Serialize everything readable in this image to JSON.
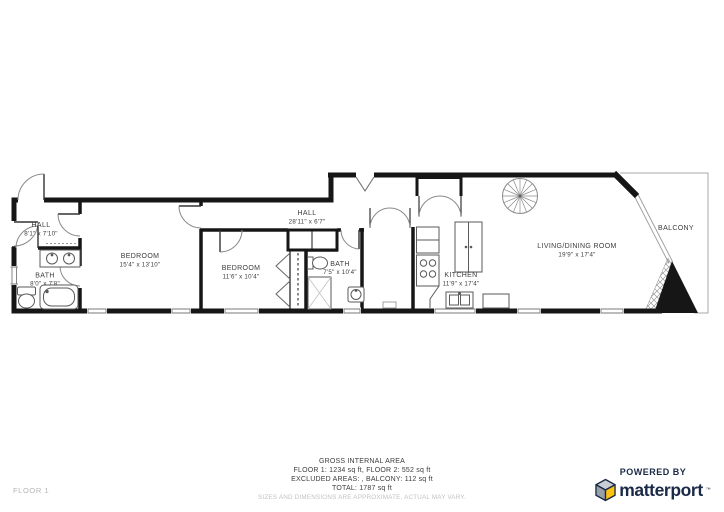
{
  "rooms": [
    {
      "name": "HALL",
      "dims": "8'1\" x 7'10\""
    },
    {
      "name": "BEDROOM",
      "dims": "15'4\" x 13'10\""
    },
    {
      "name": "BATH",
      "dims": "8'0\" x 7'8\""
    },
    {
      "name": "HALL",
      "dims": "28'11\" x 6'7\""
    },
    {
      "name": "BEDROOM",
      "dims": "11'6\" x 10'4\""
    },
    {
      "name": "BATH",
      "dims": "7'5\" x 10'4\""
    },
    {
      "name": "KITCHEN",
      "dims": "11'9\" x 17'4\""
    },
    {
      "name": "LIVING/DINING ROOM",
      "dims": "19'9\" x 17'4\""
    },
    {
      "name": "BALCONY",
      "dims": ""
    }
  ],
  "footer": {
    "title": "GROSS INTERNAL AREA",
    "line_floors": "FLOOR 1: 1234 sq ft, FLOOR 2: 552 sq ft",
    "line_excluded": "EXCLUDED AREAS: , BALCONY: 112 sq ft",
    "line_total": "TOTAL: 1787 sq ft",
    "disclaimer": "SIZES AND DIMENSIONS ARE APPROXIMATE, ACTUAL MAY VARY."
  },
  "floor_indicator": "FLOOR 1",
  "branding": {
    "powered_by": "POWERED BY",
    "brand_name": "matterport",
    "trademark": "™"
  },
  "colors": {
    "wall": "#161616",
    "brand_navy": "#1b2a47",
    "brand_yellow": "#fdc113",
    "cube_gray_top": "#c9ced4",
    "cube_gray_left": "#98a1aa",
    "label_text": "#3c3c3c",
    "muted_text": "#c2c2c2"
  },
  "icons": [
    "spiral-staircase-icon",
    "bathtub-icon",
    "toilet-icon",
    "sink-icon",
    "stove-icon",
    "fridge-icon",
    "wardrobe-icon",
    "shower-icon",
    "kitchen-island-icon",
    "matterport-cube-icon"
  ]
}
